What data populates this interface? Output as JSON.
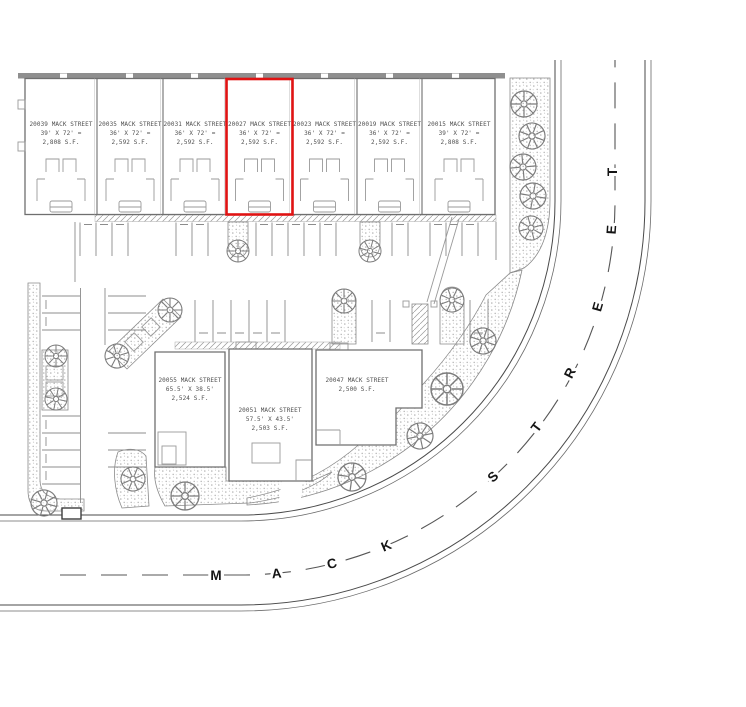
{
  "plan": {
    "title": "Mack Street townhome site plan",
    "highlight_color": "#e01313",
    "selected_unit": "20027 MACK STREET"
  },
  "units": [
    {
      "address": "20039 MACK STREET",
      "dims": "39' X 72' =",
      "area": "2,808 S.F."
    },
    {
      "address": "20035 MACK STREET",
      "dims": "36' X 72' =",
      "area": "2,592 S.F."
    },
    {
      "address": "20031 MACK STREET",
      "dims": "36' X 72' =",
      "area": "2,592 S.F."
    },
    {
      "address": "20027 MACK STREET",
      "dims": "36' X 72' =",
      "area": "2,592 S.F."
    },
    {
      "address": "20023 MACK STREET",
      "dims": "36' X 72' =",
      "area": "2,592 S.F."
    },
    {
      "address": "20019 MACK STREET",
      "dims": "36' X 72' =",
      "area": "2,592 S.F."
    },
    {
      "address": "20015 MACK STREET",
      "dims": "39' X 72' =",
      "area": "2,808 S.F."
    }
  ],
  "buildings": [
    {
      "address": "20055 MACK STREET",
      "dims": "65.5' X 38.5'",
      "area": "2,524 S.F."
    },
    {
      "address": "20051 MACK STREET",
      "dims": "57.5' X 43.5'",
      "area": "2,503 S.F."
    },
    {
      "address": "20047 MACK STREET",
      "dims": "",
      "area": "2,500 S.F."
    }
  ],
  "road": {
    "name_mack": "MACK",
    "name_street": "STREET"
  }
}
